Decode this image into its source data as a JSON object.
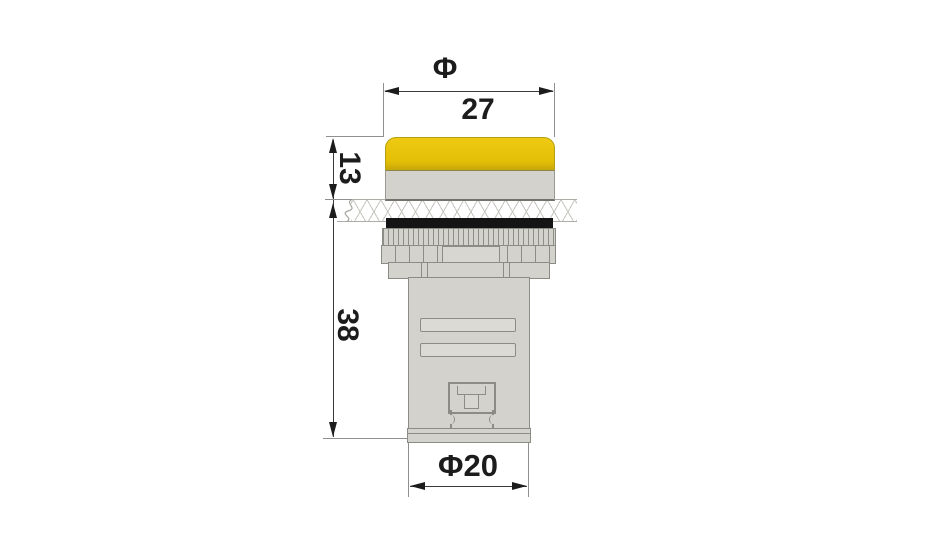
{
  "drawing": {
    "subject": "panel-mount indicator lamp, side view with installation panel",
    "labels": {
      "diameter_symbol": "Φ",
      "head_diameter": "27",
      "head_height": "13",
      "body_length": "38",
      "body_diameter": "Φ20"
    },
    "colors": {
      "lens_yellow": "#e4bf08",
      "lens_yellow_highlight": "#eeca12",
      "part_gray": "#d4d2cc",
      "gasket_black": "#141414",
      "outline_gray": "#8c8c86",
      "dimension_ink": "#1c1c1c"
    }
  }
}
